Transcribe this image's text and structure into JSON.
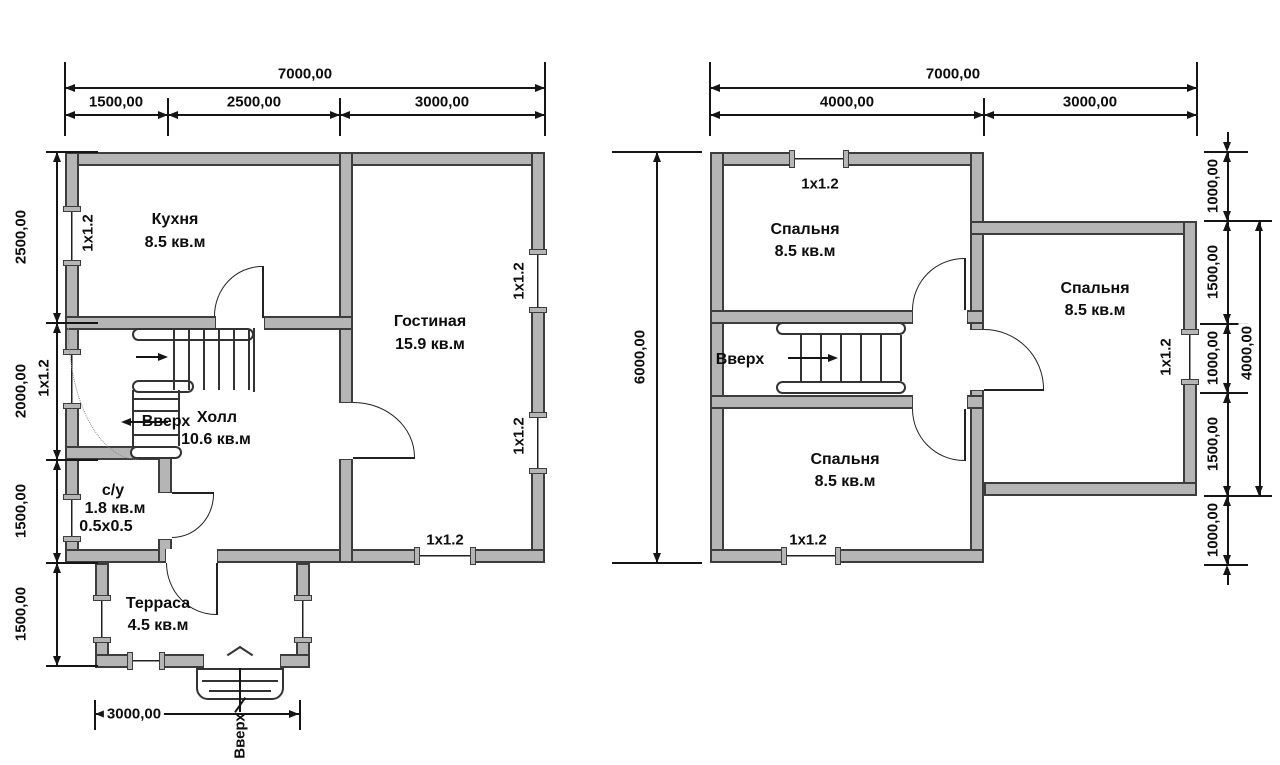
{
  "floor1": {
    "dim_top_total": "7000,00",
    "dim_top_segments": [
      "1500,00",
      "2500,00",
      "3000,00"
    ],
    "dim_left_segments": [
      "2500,00",
      "2000,00",
      "1500,00",
      "1500,00"
    ],
    "dim_terrace_width": "3000,00",
    "stairs_label": "Вверх",
    "entrance_label": "Вверх",
    "window_label": "1х1.2",
    "rooms": {
      "kitchen": {
        "name": "Кухня",
        "area": "8.5 кв.м"
      },
      "living_room": {
        "name": "Гостиная",
        "area": "15.9 кв.м"
      },
      "hall": {
        "name": "Холл",
        "area": "10.6 кв.м"
      },
      "bathroom": {
        "name": "с/у",
        "area": "1.8 кв.м",
        "size": "0.5х0.5"
      },
      "terrace": {
        "name": "Терраса",
        "area": "4.5 кв.м"
      }
    }
  },
  "floor2": {
    "dim_top_total": "7000,00",
    "dim_top_segments": [
      "4000,00",
      "3000,00"
    ],
    "dim_left_total": "6000,00",
    "dim_right_segments": [
      "1000,00",
      "1500,00",
      "1000,00",
      "1500,00",
      "1000,00"
    ],
    "dim_right_inner_total": "4000,00",
    "stairs_label": "Вверх",
    "window_label": "1х1.2",
    "rooms": {
      "bedroom_top": {
        "name": "Спальня",
        "area": "8.5 кв.м"
      },
      "bedroom_right": {
        "name": "Спальня",
        "area": "8.5 кв.м"
      },
      "bedroom_bottom": {
        "name": "Спальня",
        "area": "8.5 кв.м"
      }
    }
  },
  "colors": {
    "wall_fill": "#b5b5b5",
    "wall_edge": "#3d3d3d",
    "line": "#151515"
  }
}
